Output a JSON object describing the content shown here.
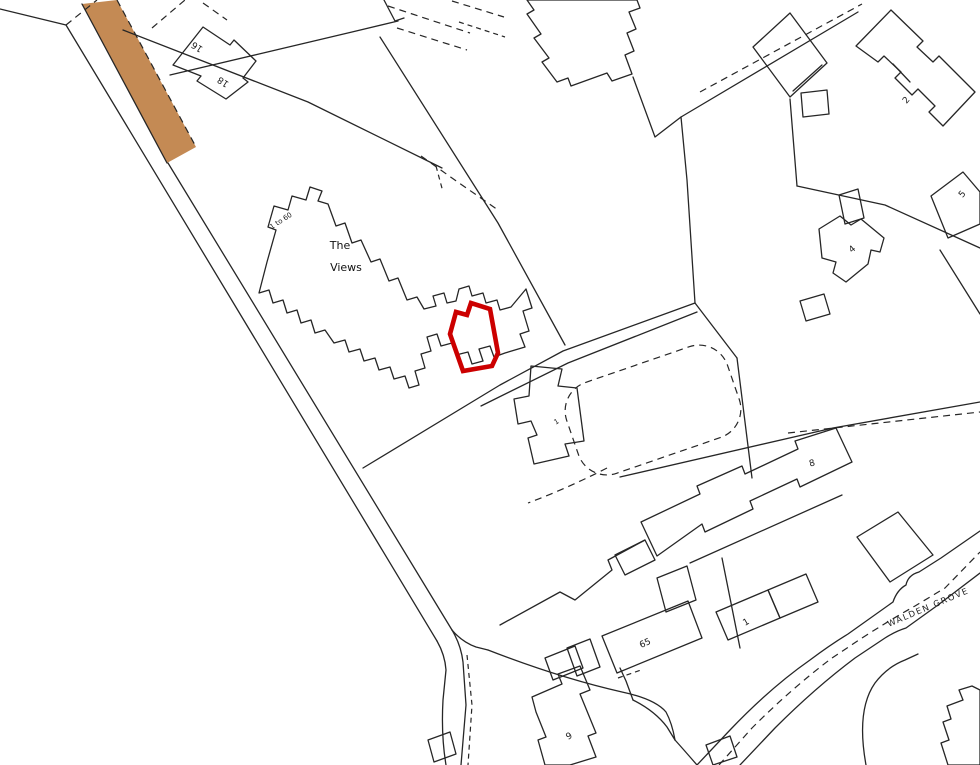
{
  "map": {
    "kind": "site-location-plan",
    "labels": {
      "building_a_number": "16",
      "building_b_number": "18",
      "views_range": "1 to 60",
      "views_name_line1": "The",
      "views_name_line2": "Views",
      "street_name": "WALDEN GROVE",
      "house_2": "2",
      "house_5": "5",
      "house_4": "4",
      "house_8": "8",
      "house_1": "1",
      "house_65": "65",
      "house_9": "9",
      "house_small": "1"
    },
    "colors": {
      "line": "#262626",
      "plot_outline": "#cc0000",
      "surface_fill": "#c48a54",
      "background": "#ffffff"
    }
  }
}
